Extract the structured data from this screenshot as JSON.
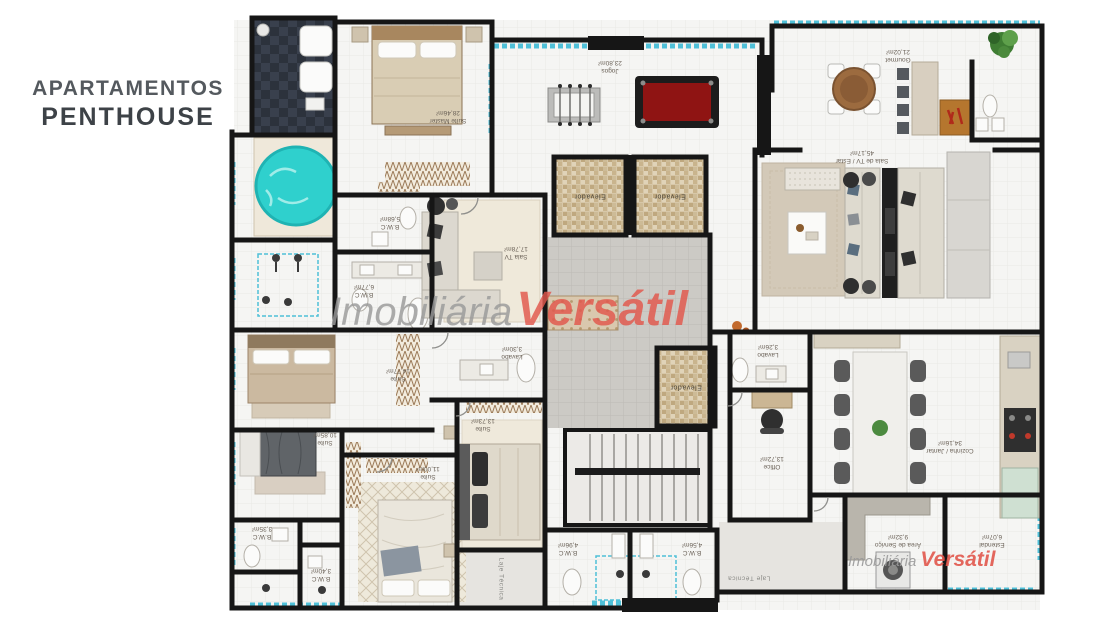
{
  "title": {
    "line1": "APARTAMENTOS",
    "line2": "PENTHOUSE"
  },
  "watermark": {
    "prefix": "Imobiliária",
    "brand": "Versátil"
  },
  "labels": {
    "elevator": "Elevador",
    "technical_slab": "Laje Técnica"
  },
  "colors": {
    "accent_red": "#e2574c",
    "tile_blue": "#4fc0d8",
    "jacuzzi": "#2fd0cd",
    "pool_felt": "#8f1413",
    "wall": "#161616"
  },
  "rooms": [
    {
      "name": "Suíte Master",
      "area": "28,46m²"
    },
    {
      "name": "Jogos",
      "area": "23,80m²"
    },
    {
      "name": "Gourmet",
      "area": "21,02m²"
    },
    {
      "name": "Sala de TV / Estar",
      "area": "45,17m²"
    },
    {
      "name": "Sala TV",
      "area": "17,78m²"
    },
    {
      "name": "B.W.C",
      "area": "5,68m²"
    },
    {
      "name": "B.W.C",
      "area": "6,77m²"
    },
    {
      "name": "Suíte",
      "area": "14,77m²"
    },
    {
      "name": "Suíte",
      "area": "10,85m²"
    },
    {
      "name": "B.W.C",
      "area": "3,35m²"
    },
    {
      "name": "B.W.C",
      "area": "3,40m²"
    },
    {
      "name": "Suíte",
      "area": "11,00m²"
    },
    {
      "name": "Suíte",
      "area": "13,73m²"
    },
    {
      "name": "Lavabo",
      "area": "3,30m²"
    },
    {
      "name": "Lavabo",
      "area": "3,26m²"
    },
    {
      "name": "Office",
      "area": "13,72m²"
    },
    {
      "name": "Cozinha / Jantar",
      "area": "34,16m²"
    },
    {
      "name": "Área de Serviço",
      "area": "9,32m²"
    },
    {
      "name": "Estendal",
      "area": "6,07m²"
    },
    {
      "name": "B.W.C",
      "area": "4,96m²"
    },
    {
      "name": "B.W.C",
      "area": "4,56m²"
    }
  ]
}
